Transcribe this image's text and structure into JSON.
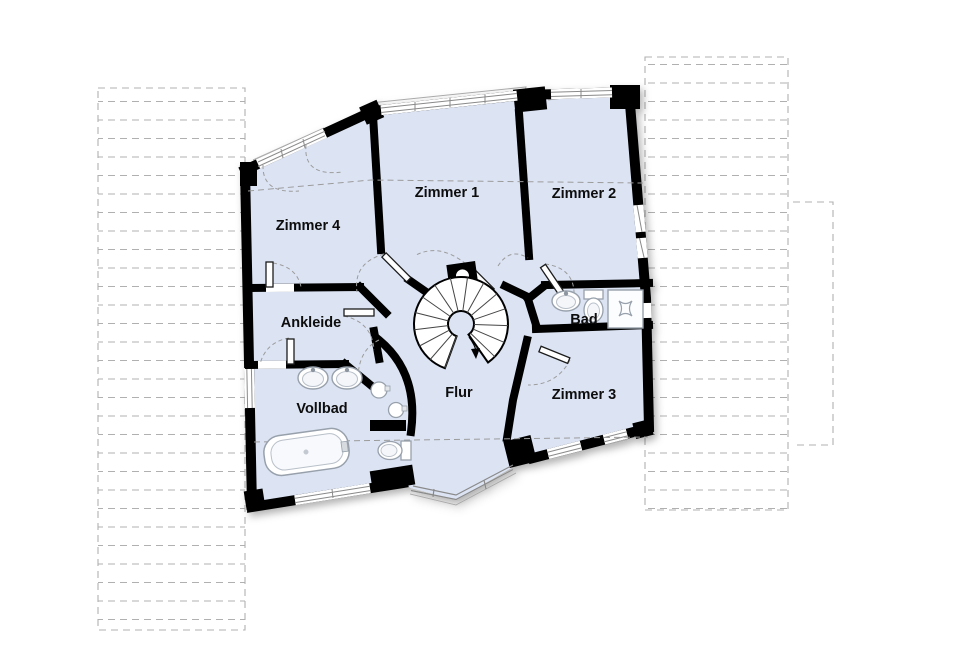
{
  "plan": {
    "type": "floor-plan",
    "language": "de",
    "rooms": {
      "zimmer1": "Zimmer 1",
      "zimmer2": "Zimmer 2",
      "zimmer3": "Zimmer 3",
      "zimmer4": "Zimmer 4",
      "ankleide": "Ankleide",
      "vollbad": "Vollbad",
      "bad": "Bad",
      "flur": "Flur"
    },
    "icons": {
      "stair": "spiral-staircase-icon",
      "bathtub": "bathtub-icon",
      "washbasin": "washbasin-icon",
      "toilet": "toilet-icon",
      "shower": "shower-icon",
      "chimney": "chimney-icon",
      "direction_arrow": "stair-direction-arrow"
    },
    "colors": {
      "floor": "#dce4f4",
      "wall": "#000000",
      "hatch": "#b0b0b0",
      "window_line": "#8a8a8a",
      "swing_arc": "#9b9b9b",
      "fixture_outline": "#97a0ab"
    }
  }
}
